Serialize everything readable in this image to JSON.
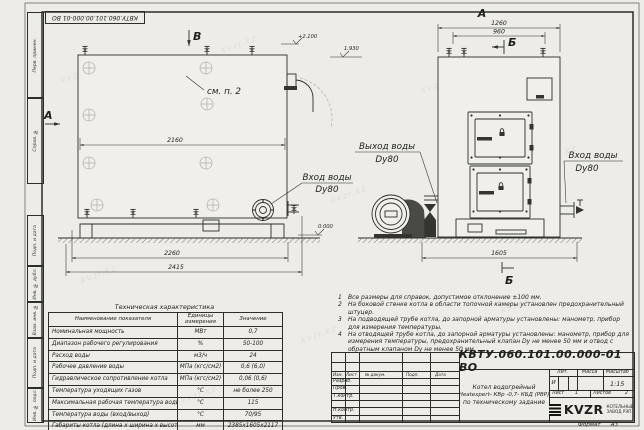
{
  "meta": {
    "watermark": "kvzr.kz",
    "format_label": "Формат",
    "format_value": "А3"
  },
  "frame": {
    "doc_number_top": "КВТУ.060.101.00.000-01 ВО",
    "side_labels": [
      "Перв. примен.",
      "Справ. №",
      "Подп. и дата",
      "Инв. № дубл.",
      "Взам. инв. №",
      "Подп. и дата",
      "Инв. № подл."
    ]
  },
  "drawing": {
    "view_a": "А",
    "view_b": "Б",
    "view_v": "В",
    "see_note": "см. п. 2",
    "elev_top": "+2.100",
    "elev_mid": "1.930",
    "elev_zero": "0.000",
    "dims": {
      "d2160": "2160",
      "d2260": "2260",
      "d2415": "2415",
      "d1260": "1260",
      "d960": "960",
      "d1605": "1605"
    },
    "labels": {
      "outlet": "Выход воды",
      "inlet": "Вход воды",
      "dn": "Dy80"
    }
  },
  "notes": [
    {
      "n": "1",
      "text": "Все размеры для справок, допустимое отклонение ±100 мм."
    },
    {
      "n": "2",
      "text": "На боковой стенке котла в области топочной камеры установлен предохранительный штуцер."
    },
    {
      "n": "3",
      "text": "На подводящей трубе котла, до запорной арматуры установлены: манометр, прибор для измерения температуры."
    },
    {
      "n": "4",
      "text": "На отводящей трубе котла, до запорной арматуры установлены: манометр, прибор для измерения температуры, предохранительный клапан Dу не менее 50 мм и отвод с обратным клапаном Dу не менее 50 мм."
    }
  ],
  "spec_table": {
    "title": "Техническая характеристика",
    "headers": [
      "Наименование показателя",
      "Единицы измерения",
      "Значение"
    ],
    "rows": [
      [
        "Номинальная мощность",
        "МВт",
        "0,7"
      ],
      [
        "Диапазон рабочего регулирования",
        "%",
        "50-100"
      ],
      [
        "Расход воды",
        "м3/ч",
        "24"
      ],
      [
        "Рабочее давление воды",
        "МПа (кгс/см2)",
        "0,6 (6,0)"
      ],
      [
        "Гидравлическое сопротивление котла",
        "МПа (кгс/см2)",
        "0,06 (0,6)"
      ],
      [
        "Температура уходящих газов",
        "°С",
        "не более 250"
      ],
      [
        "Максимальная рабочая температура воды",
        "°С",
        "115"
      ],
      [
        "Температура воды (вход/выход)",
        "°С",
        "70/95"
      ],
      [
        "Габариты котла (длина х ширина х высота)",
        "мм",
        "2385х1605х2117"
      ]
    ]
  },
  "title_block": {
    "doc_number": "КВТУ.060.101.00.000-01 ВО",
    "product_line1": "Котел водогрейный",
    "product_line2": "Heatexpert- КВр -0,7- КБД (РВР)",
    "product_line3": "по техническому задание",
    "cols": [
      "Изм.",
      "Лист",
      "№ докум.",
      "Подп.",
      "Дата"
    ],
    "rows": [
      "Разраб.",
      "Пров.",
      "Т.контр.",
      "Н.контр.",
      "Утв."
    ],
    "lit_label": "Лит.",
    "lit_value": "И",
    "mass_label": "Масса",
    "scale_label": "Масштаб",
    "scale_value": "1:15",
    "sheet_label": "Лист",
    "sheet_value": "1",
    "sheets_label": "Листов",
    "sheets_value": "2",
    "logo_text": "KVZR",
    "company_line1": "КОТЕЛЬНЫЙ",
    "company_line2": "ЗАВОД РЭП"
  }
}
